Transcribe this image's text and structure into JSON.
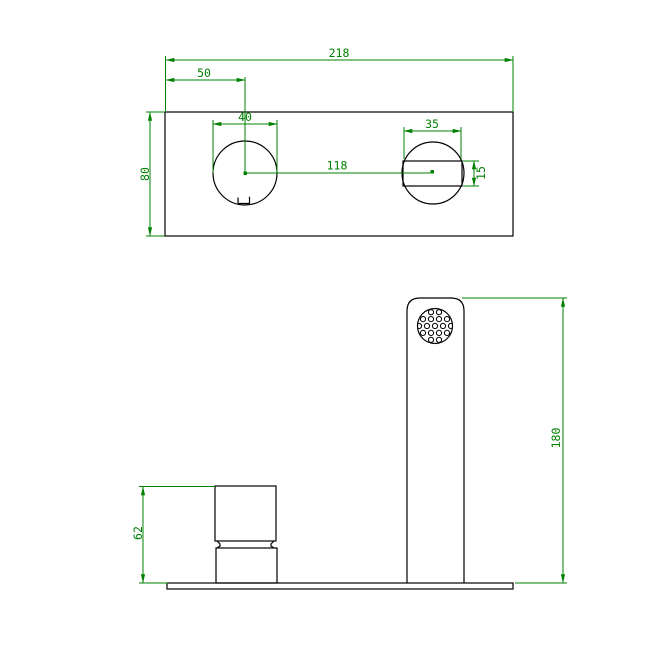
{
  "drawing": {
    "background": "#ffffff",
    "outline_color": "#000000",
    "dimension_color": "#008000",
    "plan_view": {
      "dims": {
        "overall_width": "218",
        "handle_center_offset": "50",
        "handle_hole_diameter": "40",
        "hole_center_distance": "118",
        "spout_hole_width": "35",
        "spout_slot_height": "15",
        "plate_depth": "80"
      }
    },
    "elevation_view": {
      "dims": {
        "spout_height": "180",
        "handle_height": "62"
      }
    }
  }
}
